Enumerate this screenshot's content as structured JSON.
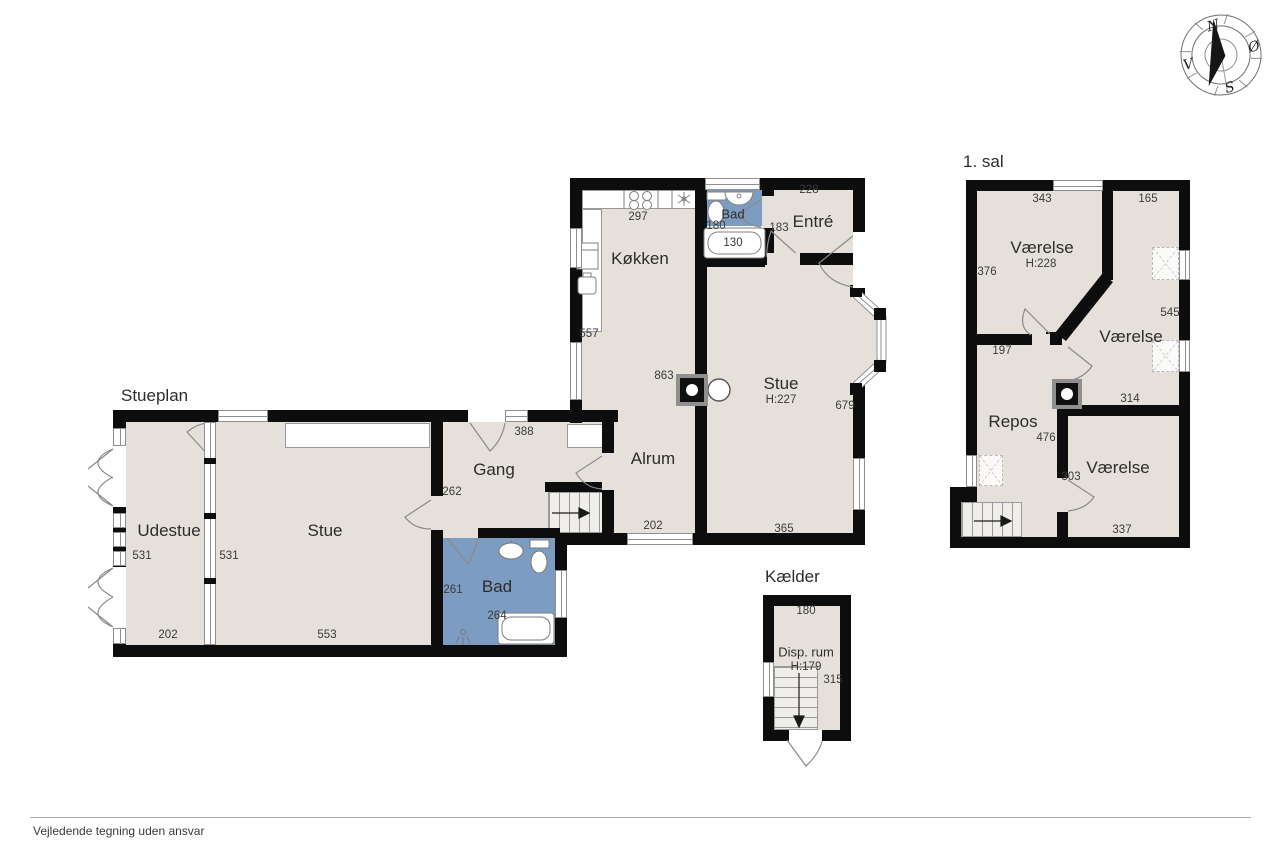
{
  "palette": {
    "floor": "#e5e1da",
    "wall": "#0d0d0d",
    "wet_room": "#7d9cc1",
    "line": "#8f8f8f"
  },
  "stueplan": {
    "title": "Stueplan",
    "rooms": {
      "udestue": "Udestue",
      "stue_left": "Stue",
      "gang": "Gang",
      "bad_nede": "Bad",
      "koekken": "Køkken",
      "alrum": "Alrum",
      "stue": "Stue",
      "stue_h": "H:227",
      "entre": "Entré",
      "bad_oppe": "Bad"
    },
    "dims": {
      "udestue_left": "531",
      "udestue_right": "531",
      "udestue_bottom": "202",
      "stue_bottom": "553",
      "gang_top": "388",
      "gang_left": "262",
      "bad_left": "261",
      "bad_bottom": "264",
      "koekken_top": "297",
      "koekken_left": "557",
      "bad_top_width": "180",
      "badekar": "130",
      "entre_left": "183",
      "entre_top": "228",
      "alrum_wall": "863",
      "alrum_bottom": "202",
      "stue_right": "679",
      "stue_bottom_right": "365"
    }
  },
  "foerste_sal": {
    "title": "1. sal",
    "rooms": {
      "v1": "Værelse",
      "v1_h": "H:228",
      "v2": "Værelse",
      "repos": "Repos",
      "v3": "Værelse"
    },
    "dims": {
      "v1_top": "343",
      "v1_left": "376",
      "v1_bottom": "197",
      "v2_top": "165",
      "v2_right": "545",
      "v2_bottom": "314",
      "repos_wall": "476",
      "v3_left": "303",
      "v3_bottom": "337"
    }
  },
  "kaelder": {
    "title": "Kælder",
    "room": "Disp. rum",
    "room_h": "H:179",
    "top": "180",
    "right": "315"
  },
  "compass": {
    "n": "N",
    "s": "S",
    "oe": "Ø",
    "v": "V"
  },
  "footer": {
    "disclaimer": "Vejledende tegning uden ansvar"
  }
}
